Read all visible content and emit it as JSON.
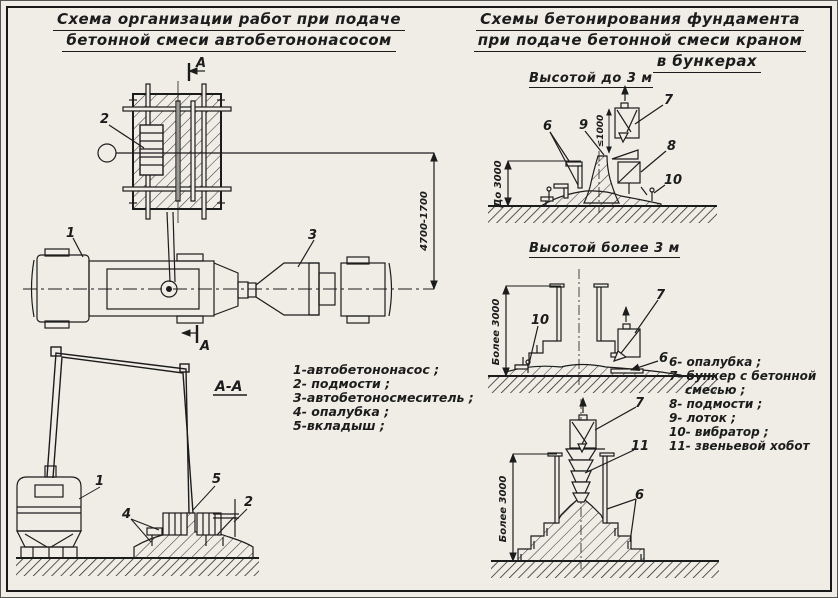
{
  "colors": {
    "paper": "#efede6",
    "ink": "#1c1c1c"
  },
  "left_panel": {
    "title_line1": "Схема организации работ при подаче",
    "title_line2": "бетонной смеси автобетононасосом",
    "section_mark_top": "А",
    "section_mark_bottom": "А",
    "section_view_label": "А-А",
    "dim_boom_reach": "4700-1700",
    "legend": [
      "1-автобетононасос ;",
      "2- подмости ;",
      "3-автобетоносмеситель ;",
      "4- опалубка ;",
      "5-вкладыш ;"
    ]
  },
  "right_panel": {
    "title_line1": "Схемы бетонирования фундамента",
    "title_line2": "при подаче бетонной смеси краном",
    "title_line3": "в бункерах",
    "scheme1_title": "Высотой до 3 м",
    "scheme2_title": "Высотой более 3 м",
    "dim_height_upto": "До 3000",
    "dim_drop": "≤1000",
    "dim_height_over_1": "Более 3000",
    "dim_height_over_2": "Более 3000",
    "legend": [
      "6- опалубка ;",
      "7- бункер с бетонной",
      "смесью ;",
      "8- подмости ;",
      "9- лоток ;",
      "10- вибратор ;",
      "11- звеньевой хобот"
    ]
  },
  "callouts": {
    "n1": "1",
    "n2": "2",
    "n3": "3",
    "n4": "4",
    "n5": "5",
    "n6": "6",
    "n7": "7",
    "n8": "8",
    "n9": "9",
    "n10": "10",
    "n11": "11"
  }
}
